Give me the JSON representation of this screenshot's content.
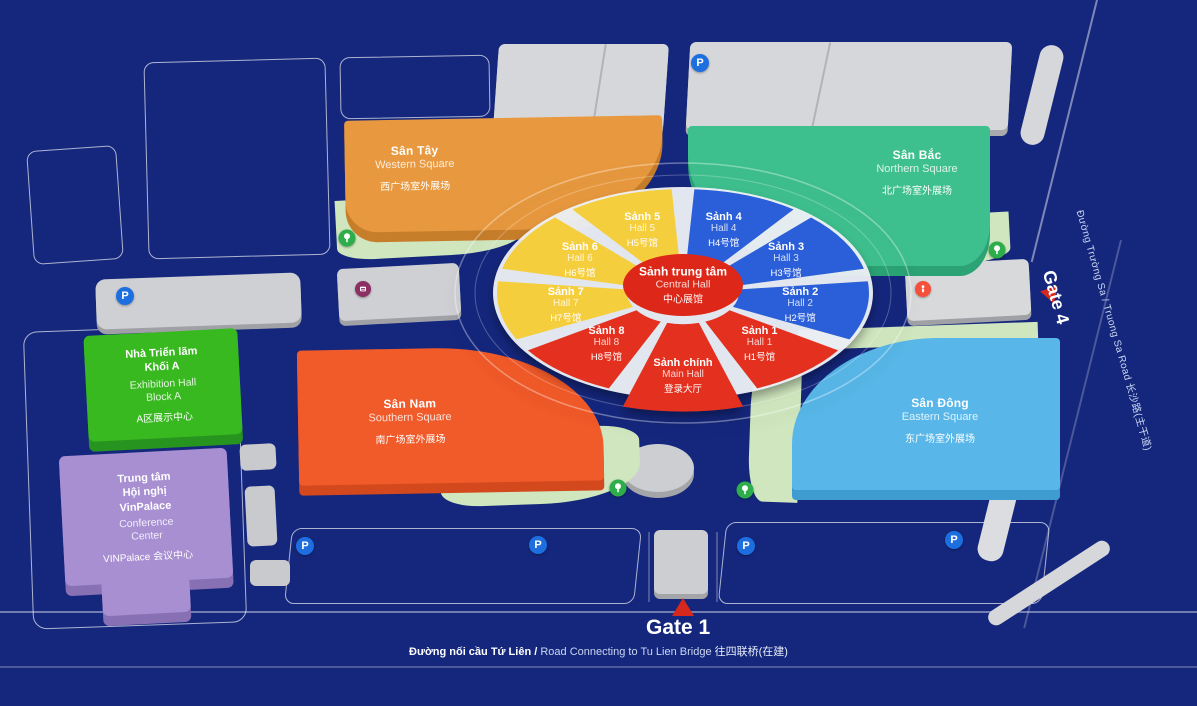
{
  "scene": {
    "background_color": "#15277D",
    "outline_color": "rgba(255,255,255,0.65)",
    "apron_color": "#CFE6BE",
    "parking_blue": "#1D6FE0",
    "tree_green": "#2EAD4B",
    "gate_red": "#D6281C"
  },
  "center_complex": {
    "hub": {
      "vi": "Sảnh trung tâm",
      "en": "Central Hall",
      "zh": "中心展馆",
      "color": "#DD2718"
    },
    "halls": [
      {
        "id": "hall5",
        "vi": "Sảnh 5",
        "en": "Hall 5",
        "zh": "H5号馆",
        "color": "#F5CE3E",
        "angle": -20
      },
      {
        "id": "hall4",
        "vi": "Sảnh 4",
        "en": "Hall 4",
        "zh": "H4号馆",
        "color": "#2B5FD9",
        "angle": 20
      },
      {
        "id": "hall3",
        "vi": "Sảnh 3",
        "en": "Hall 3",
        "zh": "H3号馆",
        "color": "#2B5FD9",
        "angle": 60
      },
      {
        "id": "hall2",
        "vi": "Sảnh 2",
        "en": "Hall 2",
        "zh": "H2号馆",
        "color": "#2B5FD9",
        "angle": 100
      },
      {
        "id": "hall1",
        "vi": "Sảnh 1",
        "en": "Hall 1",
        "zh": "H1号馆",
        "color": "#E3301F",
        "angle": 140
      },
      {
        "id": "main-hall",
        "vi": "Sảnh chính",
        "en": "Main Hall",
        "zh": "登录大厅",
        "color": "#E3301F",
        "angle": 180,
        "main": true
      },
      {
        "id": "hall8",
        "vi": "Sảnh 8",
        "en": "Hall 8",
        "zh": "H8号馆",
        "color": "#E3301F",
        "angle": 220
      },
      {
        "id": "hall7",
        "vi": "Sảnh 7",
        "en": "Hall 7",
        "zh": "H7号馆",
        "color": "#F5CE3E",
        "angle": 260
      },
      {
        "id": "hall6",
        "vi": "Sảnh 6",
        "en": "Hall 6",
        "zh": "H6号馆",
        "color": "#F5CE3E",
        "angle": 300
      }
    ]
  },
  "squares": {
    "western": {
      "vi": "Sân Tây",
      "en": "Western Square",
      "zh": "西广场室外展场",
      "color": "#E8993F",
      "side": "#C77E2B"
    },
    "northern": {
      "vi": "Sân Bắc",
      "en": "Northern Square",
      "zh": "北广场室外展场",
      "color": "#3EC08E",
      "side": "#2BA375"
    },
    "southern": {
      "vi": "Sân Nam",
      "en": "Southern Square",
      "zh": "南广场室外展场",
      "color": "#F15A29",
      "side": "#D3491D"
    },
    "eastern": {
      "vi": "Sân Đông",
      "en": "Eastern Square",
      "zh": "东广场室外展场",
      "color": "#58B7E8",
      "side": "#3F9CD0"
    }
  },
  "buildings": {
    "block_a": {
      "vi_lines": [
        "Nhà Triển lãm",
        "Khối A"
      ],
      "en_lines": [
        "Exhibition Hall",
        "Block A"
      ],
      "zh": "A区展示中心",
      "color": "#39B920",
      "side": "#27941F"
    },
    "vinpalace": {
      "vi_lines": [
        "Trung tâm",
        "Hội nghị",
        "VinPalace"
      ],
      "en_lines": [
        "Conference",
        "Center"
      ],
      "zh": "VINPalace 会议中心",
      "color": "#A78FD2",
      "side": "#8870B5"
    }
  },
  "gates": {
    "gate1": {
      "label": "Gate 1"
    },
    "gate4": {
      "label": "Gate 4"
    }
  },
  "roads": {
    "bottom": {
      "vi": "Đường nối cầu Tứ Liên /",
      "en": " Road Connecting to Tu Lien Bridge ",
      "zh": "往四联桥(在建)"
    },
    "right": {
      "text": "Đường Trường Sa / Truong Sa Road 长沙路(主干道)"
    }
  },
  "icons": {
    "parking_letter": "P",
    "instances": [
      {
        "type": "parking",
        "x": 700,
        "y": 63
      },
      {
        "type": "parking",
        "x": 125,
        "y": 296
      },
      {
        "type": "parking",
        "x": 305,
        "y": 546
      },
      {
        "type": "parking",
        "x": 538,
        "y": 545
      },
      {
        "type": "parking",
        "x": 746,
        "y": 546
      },
      {
        "type": "parking",
        "x": 954,
        "y": 540
      },
      {
        "type": "tree",
        "x": 347,
        "y": 238
      },
      {
        "type": "tree",
        "x": 997,
        "y": 250
      },
      {
        "type": "tree",
        "x": 618,
        "y": 488
      },
      {
        "type": "tree",
        "x": 745,
        "y": 490
      },
      {
        "type": "facility",
        "x": 363,
        "y": 289
      },
      {
        "type": "info",
        "x": 923,
        "y": 289
      }
    ]
  }
}
